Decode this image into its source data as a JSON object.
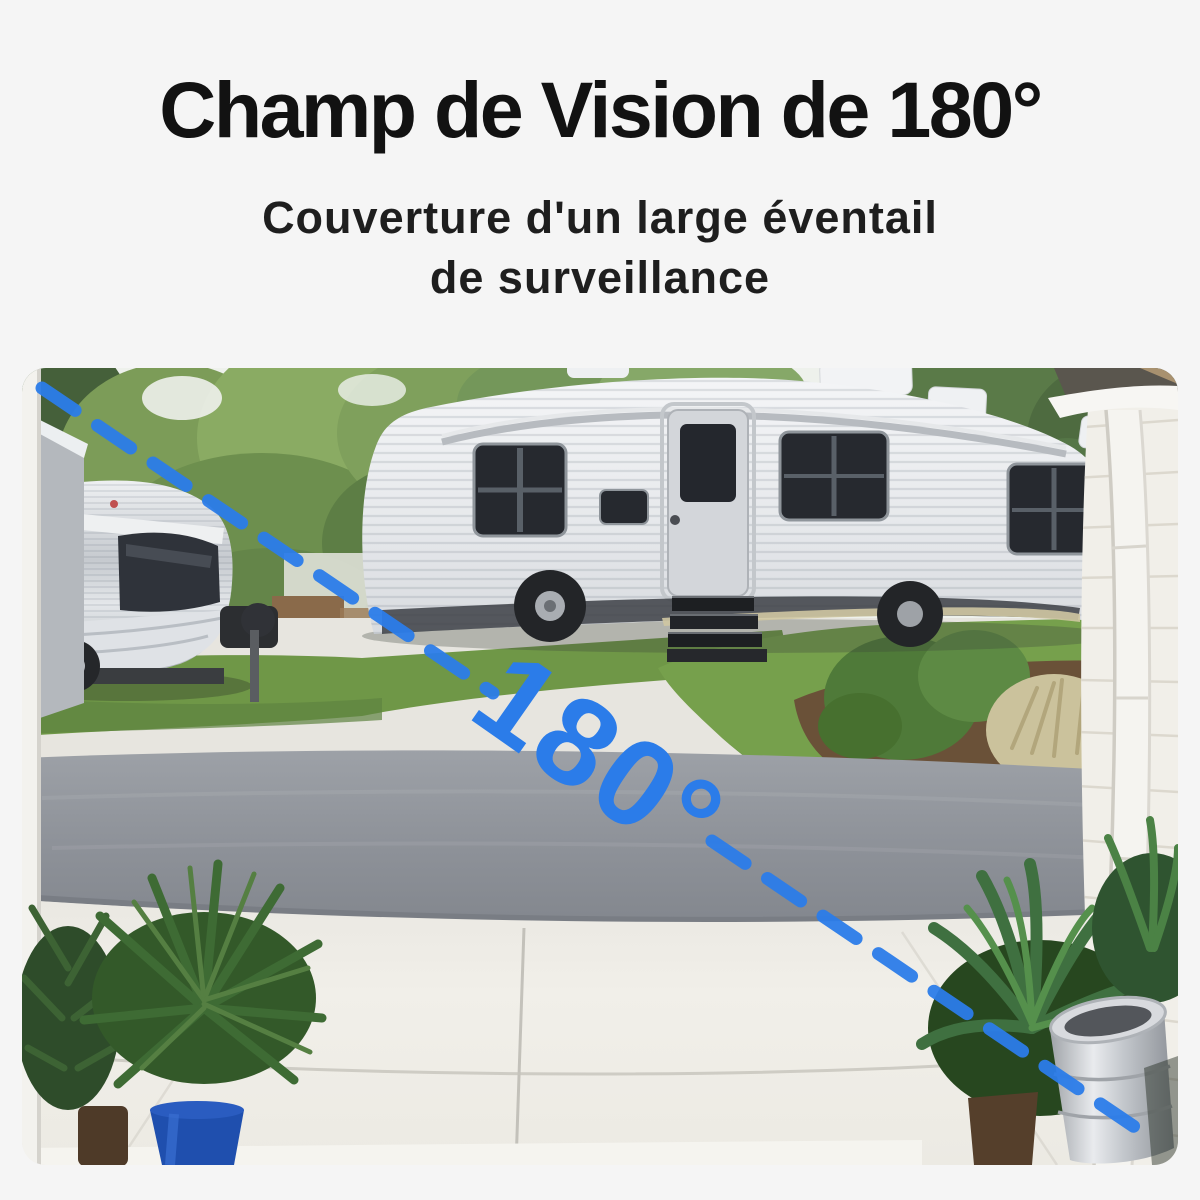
{
  "page": {
    "background_color": "#f5f5f5"
  },
  "header": {
    "title": "Champ de Vision de 180°",
    "subtitle_line1": "Couverture d'un large éventail",
    "subtitle_line2": "de surveillance",
    "text_color": "#121212"
  },
  "camera_view": {
    "fov_label": "180°",
    "accent_color": "#2b7ce9",
    "palette": {
      "lawn_green": "#6f9747",
      "asphalt_gray": "#8f939a",
      "concrete_light": "#efede7",
      "rv_white": "#e9ebee",
      "foliage_dark": "#3f6b38"
    }
  }
}
